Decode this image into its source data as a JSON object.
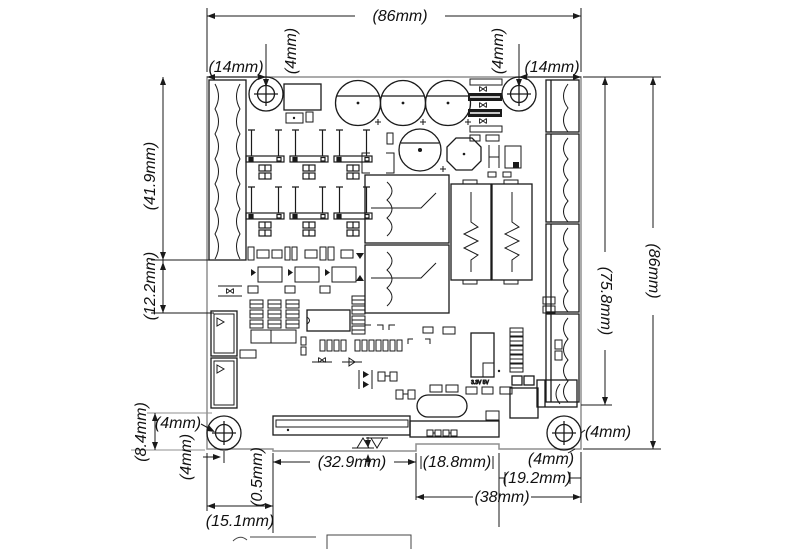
{
  "page": {
    "background": "#ffffff",
    "line_color": "#1a1a1a",
    "board_edge_color": "#8f8f8f"
  },
  "dimensions": {
    "board_width_top": "(86mm)",
    "hole_offset_top_left": "(14mm)",
    "hole_dia_top_left": "(4mm)",
    "hole_dia_top_right": "(4mm)",
    "hole_offset_top_right": "(14mm)",
    "left_terminal_span": "(41.9mm)",
    "left_section": "(12.2mm)",
    "right_terminal_span": "(75.8mm)",
    "board_height_right": "(86mm)",
    "bottom_left_inset": "(8.4mm)",
    "hole_offset_bottom_left_x": "(4mm)",
    "hole_offset_bottom_left_y": "(4mm)",
    "bottom_edge_step": "(0.5mm)",
    "bottom_left_edge": "(15.1mm)",
    "bottom_connector_width": "(32.9mm)",
    "bottom_mid_section": "(18.8mm)",
    "hole_offset_bottom_right_x": "(4mm)",
    "hole_offset_bottom_right_y": "(4mm)",
    "bottom_right_section": "(19.2mm)",
    "bottom_right_total": "(38mm)"
  },
  "silkscreen": {
    "voltage_rails": "3.3V  5V"
  }
}
